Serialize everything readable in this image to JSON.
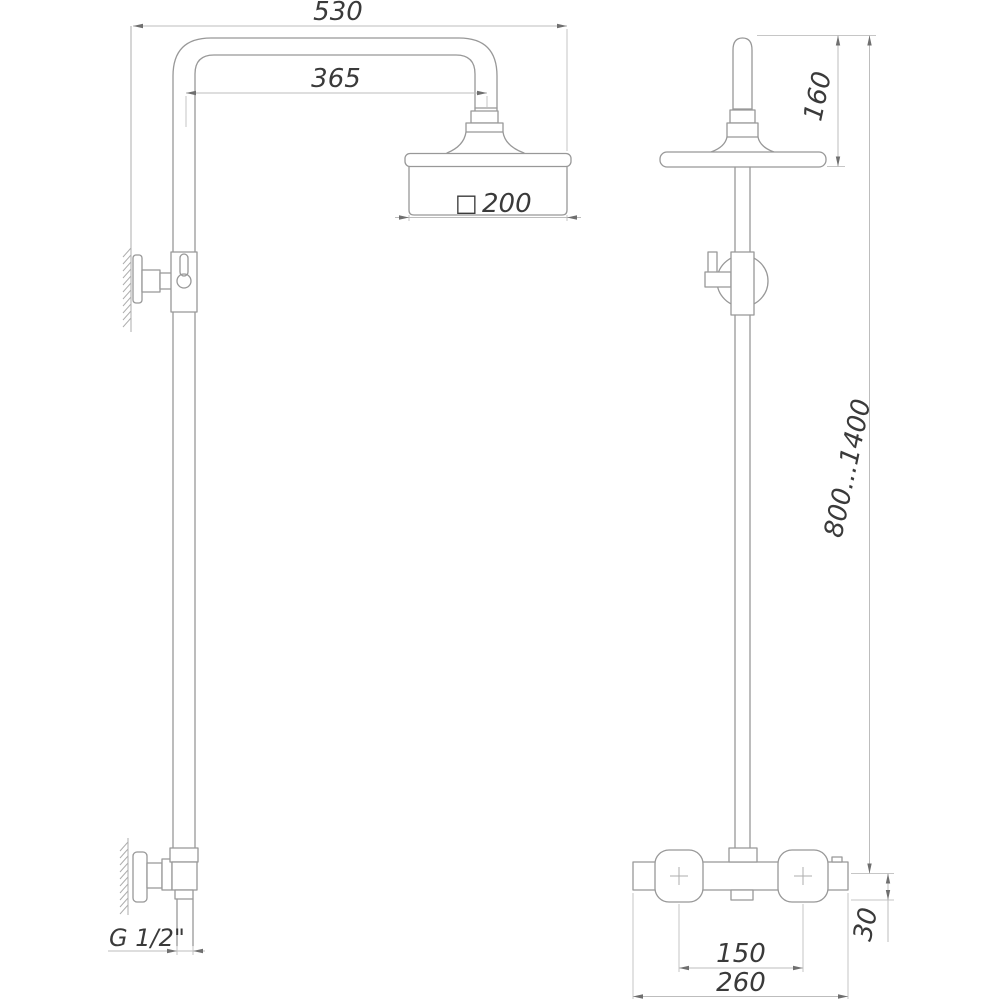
{
  "colors": {
    "background": "#ffffff",
    "outline": "#989898",
    "dimension_line": "#bdbdbd",
    "arrow": "#6f6f6f",
    "text": "#3a3a3a"
  },
  "drawing": {
    "type": "technical-dimension-drawing",
    "subject": "shower-column-system",
    "views": {
      "left": "side-view",
      "right": "front-view"
    }
  },
  "dimensions": {
    "arm_total_width": "530",
    "arm_reach": "365",
    "head_size": "200",
    "head_size_symbol": "□",
    "inlet_thread": "G 1/2\"",
    "head_height": "160",
    "column_height_range": "800...1400",
    "mixer_body_height": "30",
    "handle_centers": "150",
    "mixer_width": "260"
  }
}
